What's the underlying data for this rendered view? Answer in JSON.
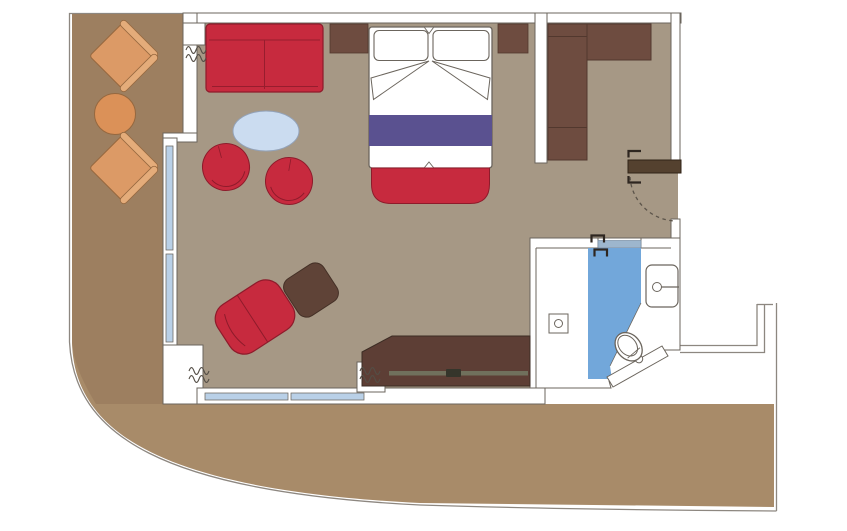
{
  "meta": {
    "title": "Suite floor plan with wrap-around terrace",
    "drawing_type": "architectural-floor-plan",
    "visible_text": "none"
  },
  "colors": {
    "background": "#ffffff",
    "wall_line": "#6b655d",
    "outer_line": "#8d8780",
    "floor": "#a69885",
    "balcony_floor": "#9d7f60",
    "promenade_deck": "#a88b69",
    "furniture_red": "#c72a3e",
    "furniture_red_dark": "#8e1b2b",
    "bed_runner_purple": "#5a5190",
    "coffee_table_blue": "#cbdcf0",
    "window_glass": "#b9d0e7",
    "bathroom_floor_blue": "#72a7da",
    "sliding_door": "#9db6cd",
    "wood_dark": "#6e4c40",
    "desk_wood": "#5d3e35",
    "ottoman_brown": "#5f4337",
    "door_leaf": "#54412f",
    "balcony_chair_orange": "#dc9a66",
    "balcony_chair_roll": "#e4ac7a",
    "balcony_table_orange": "#db9158",
    "fixture_white": "#ffffff"
  },
  "rooms": {
    "balcony": {
      "name": "private balcony",
      "furniture": [
        "lounge chair",
        "round table",
        "lounge chair"
      ]
    },
    "living_area": {
      "name": "living area",
      "furniture": [
        "two-seat sofa",
        "oval coffee table",
        "tub armchair",
        "tub armchair",
        "chaise chair",
        "ottoman",
        "desk console with rail"
      ]
    },
    "bedroom_area": {
      "name": "sleeping area",
      "furniture": [
        "double bed with two pillows",
        "bed runner",
        "foot bench",
        "nightstand left",
        "nightstand right"
      ]
    },
    "entry": {
      "name": "entry vestibule",
      "furniture": [
        "L-shaped wardrobe"
      ],
      "door": "hinged entry door with swing arc"
    },
    "bathroom": {
      "name": "bathroom",
      "fixtures": [
        "sliding door",
        "shower area with drain",
        "washbasin with faucet",
        "toilet"
      ]
    },
    "promenade": {
      "name": "wrap-around deck band"
    }
  }
}
